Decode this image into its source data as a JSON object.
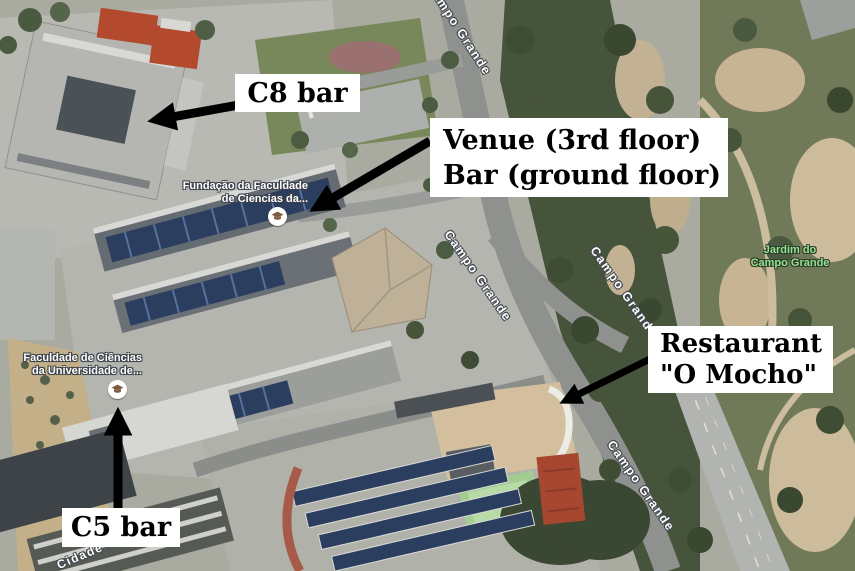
{
  "map": {
    "annotations": {
      "c8": {
        "label": "C8 bar"
      },
      "venue": {
        "line1": "Venue (3rd floor)",
        "line2": "Bar (ground floor)"
      },
      "restaurant": {
        "line1": "Restaurant",
        "line2": "\"O Mocho\""
      },
      "c5": {
        "label": "C5 bar"
      }
    },
    "poi": {
      "fundacao": {
        "line1": "Fundação da Faculdade",
        "line2": "de Ciencias da...",
        "icon": "graduation-cap-icon"
      },
      "faculdade": {
        "line1": "Faculdade de Ciências",
        "line2": "da Universidade de...",
        "icon": "graduation-cap-icon"
      }
    },
    "park": {
      "line1": "Jardim do",
      "line2": "Campo Grande"
    },
    "roads": {
      "campo_grande": "Campo Grande",
      "cidade": "Cidade"
    },
    "colors": {
      "annotation_bg": "#ffffff",
      "annotation_text": "#000000",
      "arrow": "#000000",
      "road_label": "#ffffff",
      "park_label": "#94e48e",
      "poi_icon_cap": "#7e5c40",
      "solar_panels": "#2c3e5f",
      "trees_dark": "#3e4c34",
      "park_ground": "#c6b493"
    }
  }
}
